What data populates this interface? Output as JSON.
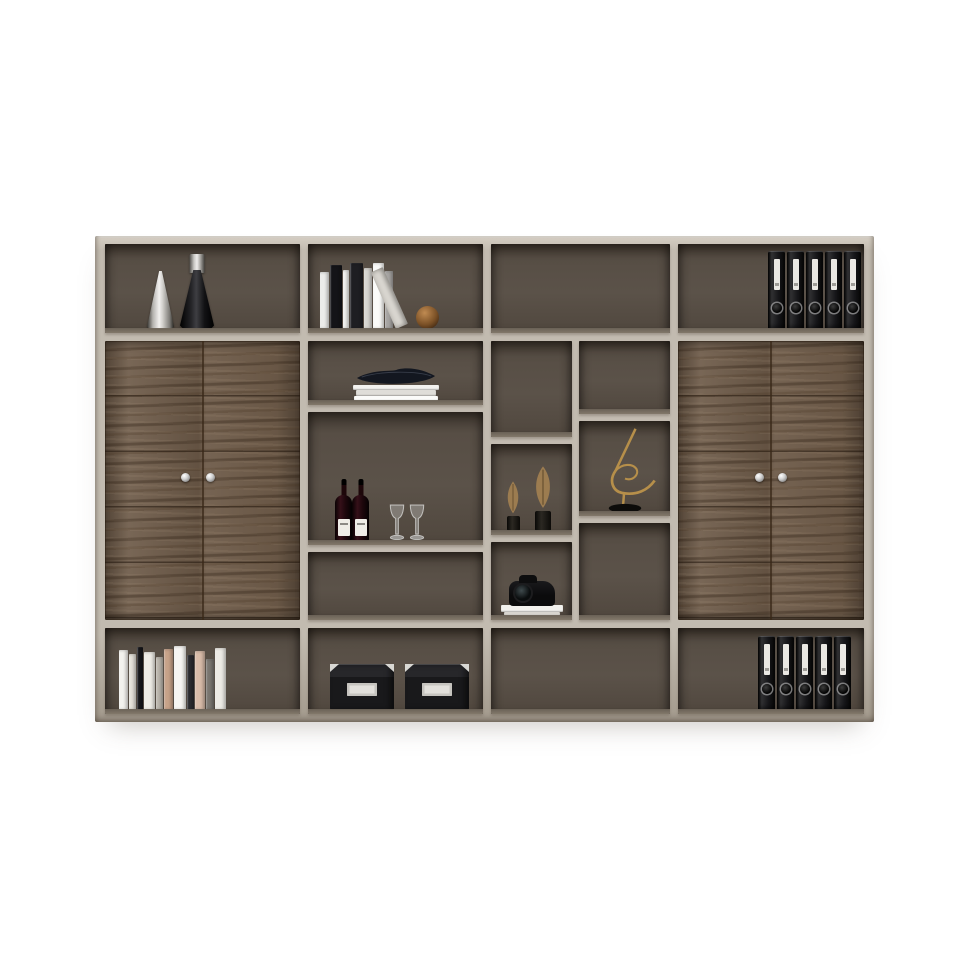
{
  "scene": {
    "type": "furniture product photograph",
    "subject": "modern office wall bookcase with walnut double-door cabinets and taupe frame",
    "background": "#ffffff"
  },
  "palette": {
    "bg": "#ffffff",
    "frame": "#c2bbb0",
    "frameLight": "#d6cfc4",
    "frameDark": "#a49b8e",
    "interior": "#574e45",
    "interiorDark": "#453d35",
    "floor": "#867c6e",
    "wood": "#6e5b49",
    "woodDark": "#4d3c2b",
    "leanBook": "#dbd8d2",
    "gold": "#b68f4a",
    "bronze": "#8a5c2e",
    "leaf": "#9c7c50",
    "glassStroke": "rgba(242,244,245,0.65)",
    "glassFill": "rgba(224,228,230,0.30)",
    "bowl": "#131720"
  },
  "cabinet": {
    "rows": 3,
    "top_row_compartments": 4,
    "bottom_row_compartments": 4,
    "middle_row": {
      "left_door_cabinet": {
        "doors": 2,
        "knobs": 2,
        "material": "dark walnut"
      },
      "right_door_cabinet": {
        "doors": 2,
        "knobs": 2,
        "material": "dark walnut"
      },
      "center_open_shelving_compartments": 6
    }
  },
  "decor": {
    "vases_top_left": [
      {
        "name": "silver cone vase"
      },
      {
        "name": "black cone vase with steel cap"
      }
    ],
    "top_books": {
      "spines": [
        {
          "w": 9,
          "h": 57,
          "c": "#ececea"
        },
        {
          "w": 12,
          "h": 64,
          "c": "#141418"
        },
        {
          "w": 6,
          "h": 59,
          "c": "#f4f3f0"
        },
        {
          "w": 13,
          "h": 66,
          "c": "#1e1e22"
        },
        {
          "w": 8,
          "h": 61,
          "c": "#d7d5d0"
        },
        {
          "w": 11,
          "h": 66,
          "c": "#fbfbf9"
        },
        {
          "w": 8,
          "h": 58,
          "c": "#a7a5a3"
        }
      ],
      "leaning_book": 1,
      "bronze_sphere": 1
    },
    "binders_top": {
      "count": 5,
      "w": 17,
      "h": 77
    },
    "binders_bottom": {
      "count": 5,
      "w": 17,
      "h": 73
    },
    "bowl_shelf": {
      "bowl": "black boat-shaped bowl",
      "books_under": [
        {
          "w": 86,
          "h": 5,
          "c": "#f3f2ef"
        },
        {
          "w": 80,
          "h": 6,
          "c": "#dfddd8"
        },
        {
          "w": 84,
          "h": 5,
          "c": "#fbfbf9"
        }
      ]
    },
    "wine_shelf": {
      "bottles": 2,
      "glasses": 2
    },
    "leaf_sculptures": 2,
    "dancer_sculpture": {
      "material": "gold wire on black base"
    },
    "camera_shelf": {
      "camera": 1,
      "books_under": [
        {
          "w": 62,
          "h": 7,
          "c": "#f2f1ed"
        },
        {
          "w": 56,
          "h": 4,
          "c": "#d8d5cf"
        }
      ]
    },
    "bottom_books": {
      "spines": [
        {
          "w": 9,
          "h": 60,
          "c": "#f3f2ee"
        },
        {
          "w": 7,
          "h": 56,
          "c": "#e6e3db"
        },
        {
          "w": 6,
          "h": 63,
          "c": "#17171b"
        },
        {
          "w": 11,
          "h": 58,
          "c": "#efede7"
        },
        {
          "w": 7,
          "h": 53,
          "c": "#bcb7ae"
        },
        {
          "w": 9,
          "h": 61,
          "c": "#c7a289"
        },
        {
          "w": 12,
          "h": 64,
          "c": "#f6f5f2"
        },
        {
          "w": 7,
          "h": 55,
          "c": "#2c2c30"
        },
        {
          "w": 10,
          "h": 59,
          "c": "#d9bca9"
        },
        {
          "w": 8,
          "h": 51,
          "c": "#7b7771"
        },
        {
          "w": 11,
          "h": 62,
          "c": "#eceae4"
        }
      ]
    },
    "storage_boxes": {
      "count": 2,
      "style": "black with metal corners and white label plate"
    }
  }
}
